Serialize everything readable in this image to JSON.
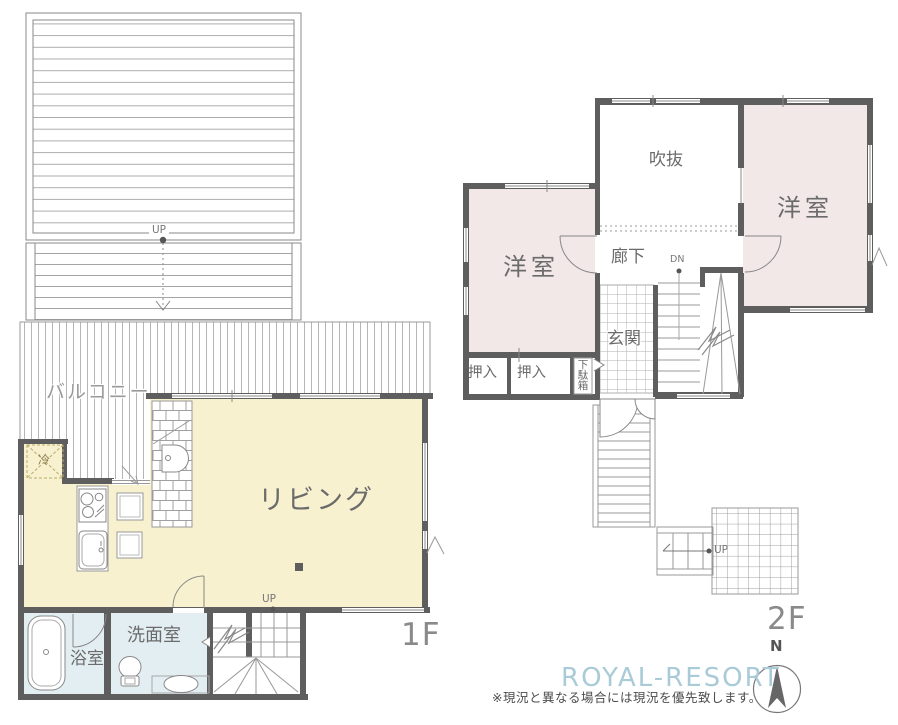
{
  "floor1": {
    "floor_label": "1F",
    "slope": {
      "up_label": "UP"
    },
    "balcony": {
      "label": "バルコニー"
    },
    "kitchen": {
      "fridge_label": "冷"
    },
    "living": {
      "label": "リビング"
    },
    "stairs": {
      "up_label": "UP"
    },
    "bathroom": {
      "label": "浴室"
    },
    "washroom": {
      "label": "洗面室"
    }
  },
  "floor2": {
    "floor_label": "2F",
    "void_space": {
      "label": "吹抜"
    },
    "bedroom_right": {
      "label": "洋室"
    },
    "bedroom_left": {
      "label": "洋室"
    },
    "corridor": {
      "label": "廊下"
    },
    "stairs": {
      "dn_label": "DN"
    },
    "entrance": {
      "label": "玄関"
    },
    "closet_left": {
      "label": "押入"
    },
    "closet_right": {
      "label": "押入"
    },
    "shoe_cabinet": {
      "label": "下駄箱"
    },
    "outside_stairs": {
      "up_label": "UP"
    }
  },
  "footer": {
    "brand": "ROYAL-RESORT",
    "disclaimer": "※現況と異なる場合には現況を優先致します。",
    "compass_north": "N"
  },
  "colors": {
    "wall": "#5e5e5e",
    "living_floor": "#f8f1d0",
    "bedroom_floor": "#f2e8e8",
    "bathroom_floor": "#e3eef2",
    "brand_accent": "#a9cbd7",
    "hatch_line": "#b0b0b0",
    "text": "#6b6b6b"
  }
}
